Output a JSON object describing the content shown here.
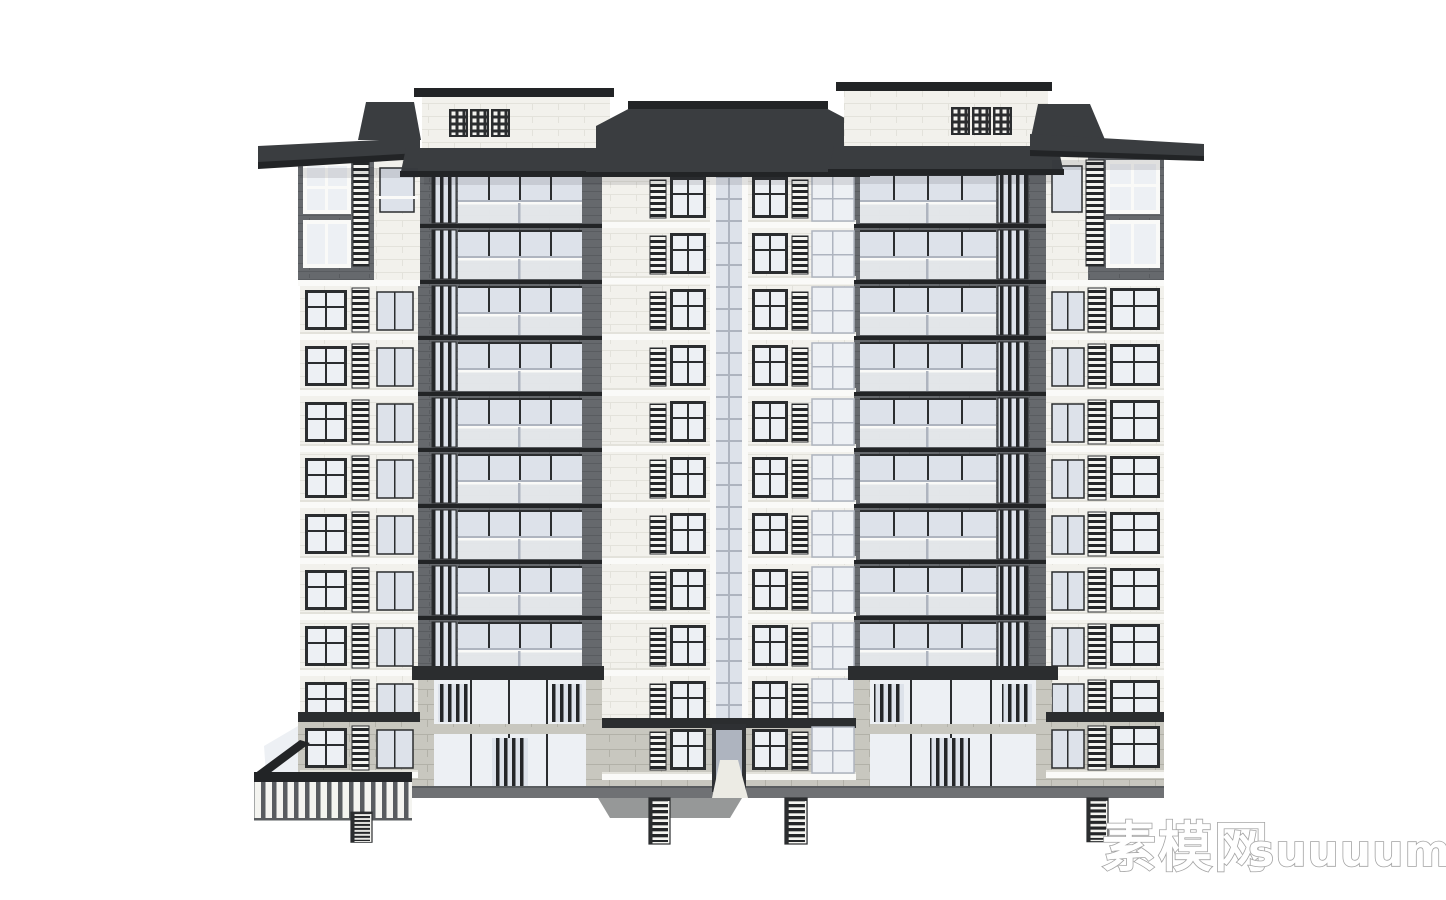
{
  "watermark": {
    "text_cn": "素模网",
    "text_latin": "suuuum.com",
    "full": "素模网suuuum.com"
  },
  "scene": {
    "description": "Front elevation render of a mid-rise residential building (SketchUp-style white model), new-Chinese style: dark hip roofs with deep eaves, white parapet blocks with lattice fretwork, two dark grey balcony towers, white tiled wings with louver vents, stone-clad base and left courtyard slat fence",
    "background": "#ffffff"
  },
  "building": {
    "repeat_floors": {
      "wing_left": 8,
      "tower_left": 9,
      "center": 10,
      "tower_right": 9,
      "wing_right": 8
    },
    "floor_height_px": 56,
    "fretwork_panels": 2,
    "fret_motifs_per_panel": 3,
    "basement_ladders": 4,
    "entrances": 1
  },
  "colors": {
    "roof": "#3a3d40",
    "roof_dark": "#222426",
    "trim": "#2b2d2f",
    "wall": "#f2f1ec",
    "wall_line": "#e3e2db",
    "brick": "#66696d",
    "brick_line": "#595c60",
    "stone": "#c8c7bf",
    "stone_line": "#b2b1a8",
    "glass": "#edf0f4",
    "glass_shade": "#dde2ea",
    "glass_dark": "#aeb4bf",
    "balustrade": "#eef1f4",
    "rail": "#fafaf8",
    "louver_dark": "#242628",
    "louver_light": "#f4f4f0",
    "ground": "#6f7174",
    "ground_line": "#595c5f",
    "watermark_fill": "#ffffff",
    "watermark_stroke": "#a3a3a3"
  }
}
